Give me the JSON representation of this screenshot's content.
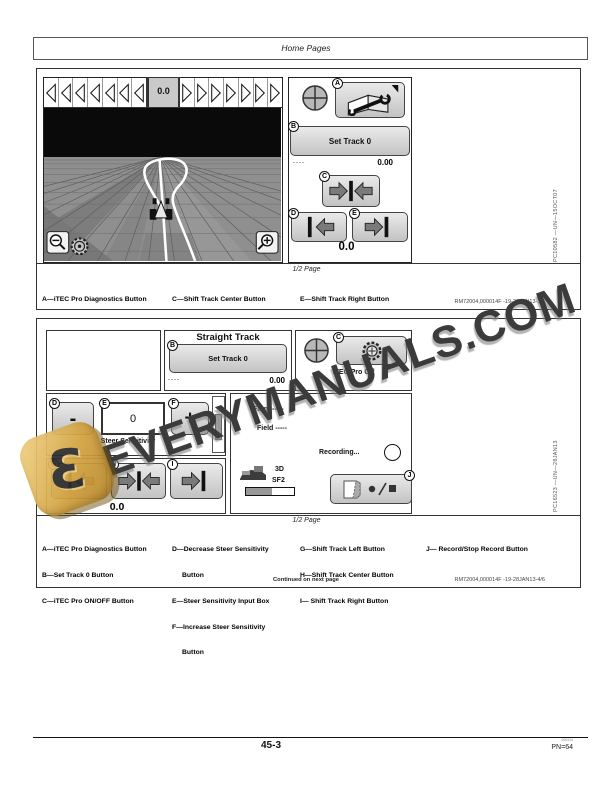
{
  "header": {
    "title": "Home Pages"
  },
  "watermark": {
    "text": "EVERYMANUALS.COM",
    "logo_icon": "stylized-e-arrow-icon"
  },
  "colors": {
    "watermark_gold": "#d2a23f",
    "watermark_gray": "#3b3b3b",
    "button_gray": "#d6d6d6"
  },
  "callouts": {
    "a": "A",
    "b": "B",
    "c": "C",
    "d": "D",
    "e": "E",
    "f": "F",
    "g": "G",
    "h": "H",
    "i": "I",
    "j": "J"
  },
  "figure1": {
    "screen": {
      "track_value": "0.0",
      "set_track_button": "Set Track 0",
      "dashes": "----",
      "offset_value": "0.00",
      "bottom_value": "0.0"
    },
    "photo_id": "PC10582 —UN—15OCT07",
    "size_note": "1/2 Page",
    "captions": {
      "col1": [
        "A—iTEC Pro Diagnostics Button",
        "B—Set Track 0 Button"
      ],
      "col2": [
        "C—Shift Track Center Button",
        "D—Shift Track Left Button"
      ],
      "col3": [
        "E—Shift Track Right Button"
      ]
    },
    "ref": "RM72004,000014F -19-28JAN13-3/6"
  },
  "figure2": {
    "screen": {
      "title": "Straight Track",
      "set_track_button": "Set Track 0",
      "dashes": "----",
      "offset_value": "0.00",
      "itec_button_label": "iTEC Pro Off",
      "decrease_label": "-",
      "sensitivity_value": "0",
      "increase_label": "+",
      "sensitivity_label": "Steer Sensitivity",
      "bottom_value": "0.0",
      "farm_row": "Farm -----",
      "field_row": "Field -----",
      "recording_label": "Recording...",
      "mode_3d": "3D",
      "signal_type": "SF2"
    },
    "photo_id": "PC16523 —UN—28JAN13",
    "size_note": "1/2 Page",
    "captions": {
      "col1": [
        "A—iTEC Pro Diagnostics Button",
        "B—Set Track 0 Button",
        "C—iTEC Pro ON/OFF Button"
      ],
      "col2": [
        "D—Decrease Steer Sensitivity",
        "Button",
        "E—Steer Sensitivity Input Box",
        "F—Increase Steer Sensitivity",
        "Button"
      ],
      "col3": [
        "G—Shift Track Left Button",
        "H—Shift Track Center Button",
        "I— Shift Track Right Button"
      ],
      "col4": [
        "J— Record/Stop Record Button"
      ]
    },
    "continued": "Continued on next page",
    "ref": "RM72004,000014F -19-28JAN13-4/6"
  },
  "footer": {
    "page_number": "45-3",
    "print_code": "090314",
    "pn": "PN=64"
  },
  "icons": [
    "crosshair-icon",
    "diagnostics-book-wrench-icon",
    "gear-icon",
    "magnifier-minus-icon",
    "magnifier-plus-icon",
    "shift-left-icon",
    "shift-center-icon",
    "shift-right-icon",
    "vehicle-icon",
    "field-record-icon",
    "record-circle-icon"
  ]
}
